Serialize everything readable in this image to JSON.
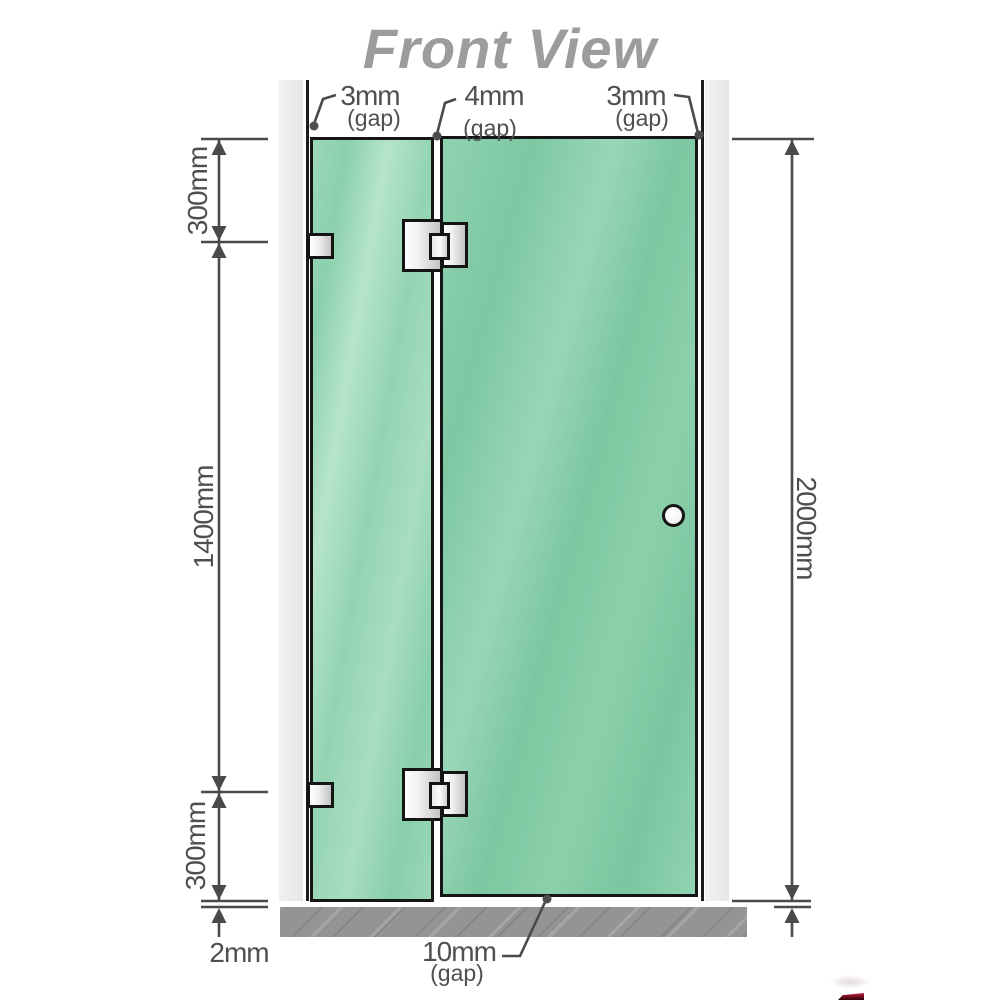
{
  "title": "Front View",
  "annotations": {
    "gap_top_left": {
      "value": "3mm",
      "qualifier": "(gap)"
    },
    "gap_top_middle": {
      "value": "4mm",
      "qualifier": "(gap)"
    },
    "gap_top_right": {
      "value": "3mm",
      "qualifier": "(gap)"
    },
    "gap_bottom": {
      "value": "10mm",
      "qualifier": "(gap)"
    },
    "segment_top": "300mm",
    "segment_middle": "1400mm",
    "segment_bottom": "300mm",
    "floor_clearance": "2mm",
    "total_height": "2000mm"
  },
  "colors": {
    "glass_green": "#7fcaa5",
    "glass_green_light": "#a8ddc1",
    "wall_gray": "#ececec",
    "floor_gray": "#949494",
    "hardware_silver": "#d9d9d9",
    "outline_black": "#161616",
    "dimension_gray": "#4a4a4a",
    "title_gray": "#9c9c9c",
    "watermark_red": "#a01030"
  }
}
